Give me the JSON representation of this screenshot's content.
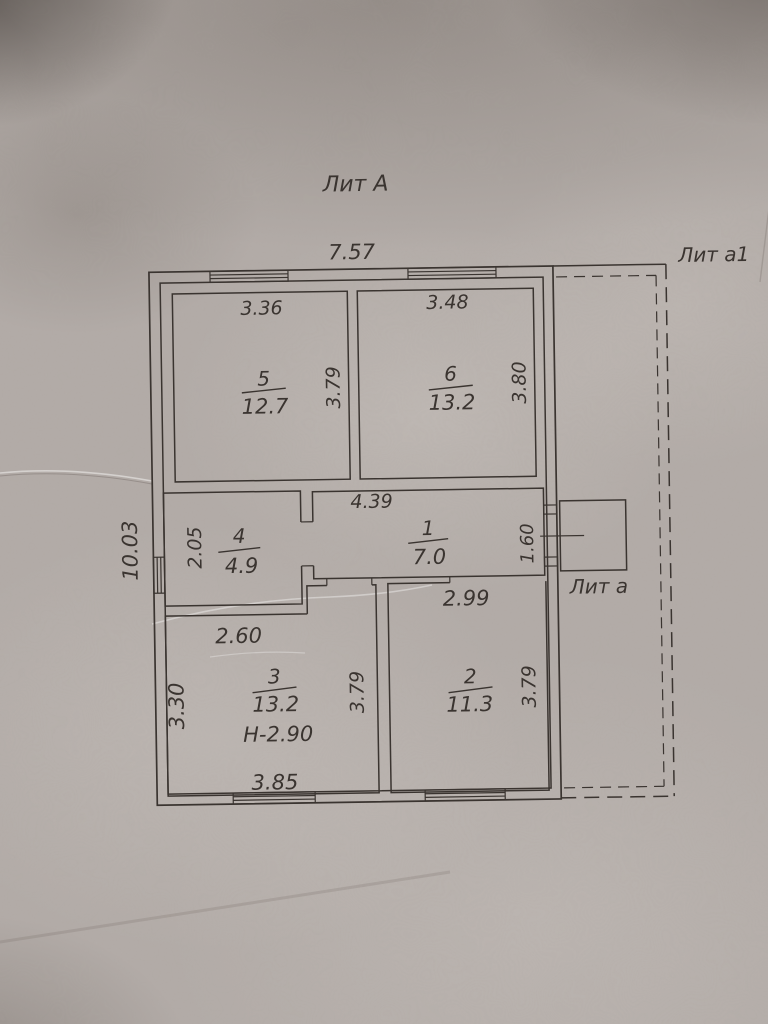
{
  "plan": {
    "building_label": "Лит А",
    "veranda_label": "Лит а1",
    "porch_label": "Лит а",
    "overall": {
      "width_m": "7.57",
      "depth_m": "10.03"
    }
  },
  "rooms": {
    "r1": {
      "number": "1",
      "area_m2": "7.0",
      "dim_top": "4.39",
      "dim_right": "1.60"
    },
    "r2": {
      "number": "2",
      "area_m2": "11.3",
      "dim_top": "2.99",
      "dim_right": "3.79"
    },
    "r3": {
      "number": "3",
      "area_m2": "13.2",
      "ceiling_height": "Н-2.90",
      "dim_top": "2.60",
      "dim_left": "3.30",
      "dim_right": "3.79",
      "dim_bottom": "3.85"
    },
    "r4": {
      "number": "4",
      "area_m2": "4.9",
      "dim_left": "2.05"
    },
    "r5": {
      "number": "5",
      "area_m2": "12.7",
      "dim_top": "3.36",
      "dim_right": "3.79"
    },
    "r6": {
      "number": "6",
      "area_m2": "13.2",
      "dim_top": "3.48",
      "dim_right": "3.80"
    }
  },
  "colors": {
    "ink": "#3a3430",
    "paper": "#b3aca8"
  }
}
